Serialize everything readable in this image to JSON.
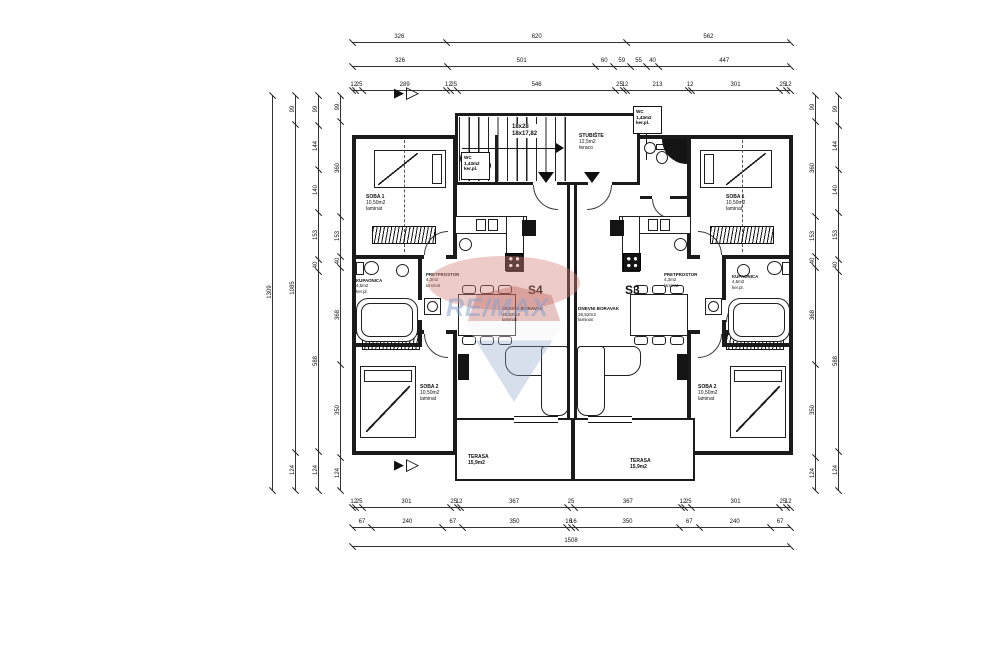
{
  "apartments": {
    "left_id": "S4",
    "right_id": "S3"
  },
  "rooms": {
    "stairs": {
      "steps_a": "18x28",
      "steps_b": "18x17,82"
    },
    "stubiste": {
      "name": "STUBIŠTE",
      "area": "12,5m2",
      "floor": "teraco"
    },
    "wc": {
      "name": "WC",
      "area": "1,43m2",
      "floor": "ker.pl."
    },
    "soba1": {
      "name": "SOBA 1",
      "area": "10,50m2",
      "floor": "laminat"
    },
    "soba2": {
      "name": "SOBA 2",
      "area": "10,50m2",
      "floor": "laminat"
    },
    "kupaonica": {
      "name": "KUPAONICA",
      "area": "4,5m2",
      "floor": "ker.pl."
    },
    "pretprostor": {
      "name": "PRETPROSTOR",
      "area": "4,3m2",
      "floor": "laminat"
    },
    "dnevni": {
      "name": "DNEVNI BORAVAK",
      "area": "26,52m2",
      "floor": "laminat"
    },
    "terasa": {
      "name": "TERASA",
      "area": "15,9m2"
    }
  },
  "watermark": {
    "text": "RE/MAX",
    "red": "#b8554e",
    "blue": "#8fa3c8"
  },
  "dimensions": {
    "h_rows": [
      {
        "x": 352,
        "y": 42,
        "len": 438,
        "segs": [
          326,
          620,
          562
        ]
      },
      {
        "x": 352,
        "y": 66,
        "len": 438,
        "segs": [
          326,
          501,
          60,
          59,
          55,
          40,
          447
        ]
      },
      {
        "x": 352,
        "y": 90,
        "len": 438,
        "segs": [
          12,
          25,
          289,
          12,
          25,
          546,
          25,
          12,
          213,
          12,
          301,
          25,
          12
        ]
      },
      {
        "x": 352,
        "y": 507,
        "len": 438,
        "segs": [
          12,
          25,
          301,
          25,
          12,
          367,
          25,
          367,
          12,
          25,
          301,
          25,
          12
        ]
      },
      {
        "x": 352,
        "y": 527,
        "len": 438,
        "segs": [
          67,
          240,
          67,
          350,
          16,
          16,
          350,
          67,
          240,
          67
        ]
      },
      {
        "x": 352,
        "y": 546,
        "len": 438,
        "segs": [
          1508
        ]
      }
    ],
    "v_rows": [
      {
        "x": 272,
        "y": 95,
        "len": 395,
        "segs": [
          1309
        ]
      },
      {
        "x": 295,
        "y": 95,
        "len": 395,
        "segs": [
          99,
          1085,
          124
        ]
      },
      {
        "x": 318,
        "y": 95,
        "len": 395,
        "segs": [
          99,
          144,
          140,
          153,
          40,
          588,
          124
        ]
      },
      {
        "x": 340,
        "y": 95,
        "len": 395,
        "segs": [
          99,
          360,
          153,
          40,
          368,
          350,
          124
        ]
      },
      {
        "x": 815,
        "y": 95,
        "len": 395,
        "segs": [
          99,
          360,
          153,
          40,
          368,
          350,
          124
        ]
      },
      {
        "x": 838,
        "y": 95,
        "len": 395,
        "segs": [
          99,
          144,
          140,
          153,
          40,
          588,
          124
        ]
      }
    ]
  }
}
